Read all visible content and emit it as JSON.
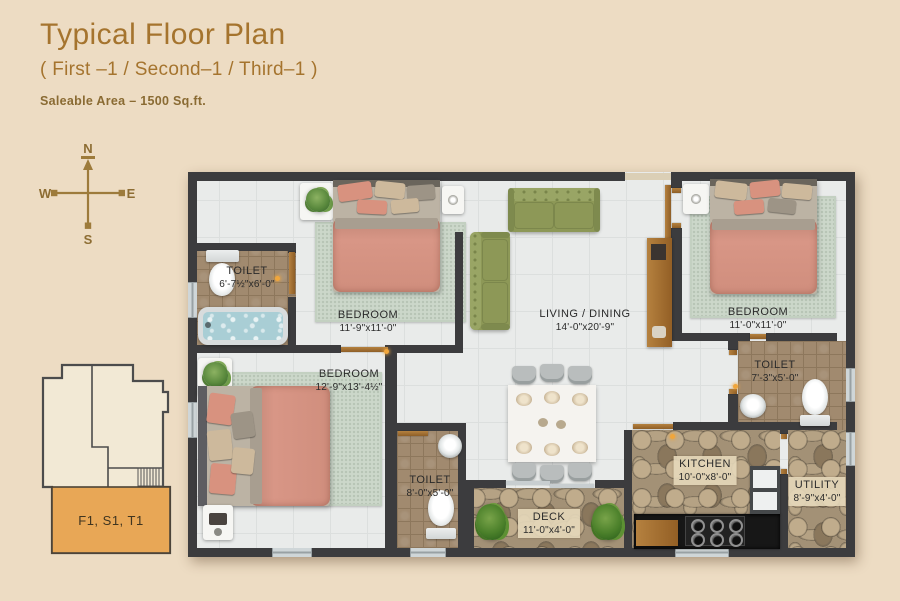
{
  "header": {
    "title": "Typical Floor Plan",
    "subtitle": "( First –1 / Second–1 / Third–1 )",
    "area_label": "Saleable Area – 1500 Sq.ft."
  },
  "compass": {
    "n": "N",
    "e": "E",
    "s": "S",
    "w": "W"
  },
  "keyplan": {
    "unit_label": "F1, S1, T1"
  },
  "rooms": {
    "toilet1": {
      "name": "TOILET",
      "dims": "6'-7½\"x6'-0\""
    },
    "bedroom1": {
      "name": "BEDROOM",
      "dims": "11'-9\"x11'-0\""
    },
    "living": {
      "name": "LIVING / DINING",
      "dims": "14'-0\"x20'-9\""
    },
    "bedroom2": {
      "name": "BEDROOM",
      "dims": "11'-0\"x11'-0\""
    },
    "bedroom3": {
      "name": "BEDROOM",
      "dims": "12'-9\"x13'-4½\""
    },
    "toilet2": {
      "name": "TOILET",
      "dims": "8'-0\"x5'-0\""
    },
    "toilet3": {
      "name": "TOILET",
      "dims": "7'-3\"x5'-0\""
    },
    "deck": {
      "name": "DECK",
      "dims": "11'-0\"x4'-0\""
    },
    "kitchen": {
      "name": "KITCHEN",
      "dims": "10'-0\"x8'-0\""
    },
    "utility": {
      "name": "UTILITY",
      "dims": "8'-9\"x4'-0\""
    }
  },
  "colors": {
    "page_background": "#eddcc3",
    "accent_gold": "#a5742e",
    "wall": "#3c3c3e",
    "keyplan_highlight": "#e8a756",
    "bed": "#d69181",
    "sofa": "#8d9857"
  }
}
